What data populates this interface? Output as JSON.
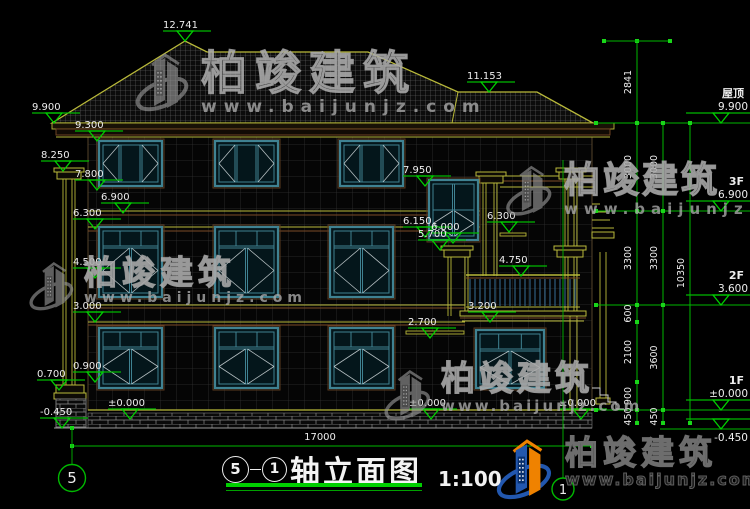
{
  "drawing": {
    "title": {
      "axis_left": "5",
      "axis_right": "1",
      "name": "轴立面图",
      "scale": "1:100"
    },
    "watermark": {
      "brand": "柏竣建筑",
      "url": "www.baijunjz.com"
    },
    "elevation_markers": [
      {
        "v": "12.741",
        "x": 185,
        "y": 41
      },
      {
        "v": "11.153",
        "x": 489,
        "y": 92
      },
      {
        "v": "9.900",
        "x": 54,
        "y": 123
      },
      {
        "v": "9.300",
        "x": 97,
        "y": 141
      },
      {
        "v": "8.250",
        "x": 63,
        "y": 171
      },
      {
        "v": "7.800",
        "x": 97,
        "y": 190
      },
      {
        "v": "6.900",
        "x": 123,
        "y": 213
      },
      {
        "v": "6.300",
        "x": 95,
        "y": 229
      },
      {
        "v": "4.500",
        "x": 95,
        "y": 278
      },
      {
        "v": "3.000",
        "x": 95,
        "y": 322
      },
      {
        "v": "0.900",
        "x": 95,
        "y": 382
      },
      {
        "v": "0.700",
        "x": 59,
        "y": 390
      },
      {
        "v": "-0.450",
        "x": 62,
        "y": 428
      },
      {
        "v": "±0.000",
        "x": 130,
        "y": 419
      },
      {
        "v": "7.950",
        "x": 425,
        "y": 186
      },
      {
        "v": "6.150",
        "x": 425,
        "y": 237
      },
      {
        "v": "6.000",
        "x": 453,
        "y": 243
      },
      {
        "v": "5.700",
        "x": 440,
        "y": 250
      },
      {
        "v": "6.300",
        "x": 509,
        "y": 232
      },
      {
        "v": "4.750",
        "x": 521,
        "y": 276
      },
      {
        "v": "3.200",
        "x": 490,
        "y": 322
      },
      {
        "v": "2.700",
        "x": 430,
        "y": 338
      },
      {
        "v": "±0.000",
        "x": 431,
        "y": 419
      },
      {
        "v": "±0.000",
        "x": 581,
        "y": 419
      }
    ],
    "floor_markers": [
      {
        "name": "屋顶",
        "v": "9.900",
        "y": 123
      },
      {
        "name": "3F",
        "v": "6.900",
        "y": 211
      },
      {
        "name": "2F",
        "v": "3.600",
        "y": 305
      },
      {
        "name": "1F",
        "v": "±0.000",
        "y": 410
      },
      {
        "name": "",
        "v": "-0.450",
        "y": 429,
        "below": true,
        "x1": 660
      }
    ],
    "vdims": [
      {
        "v": "2841",
        "x": 637,
        "y1": 41,
        "y2": 123
      },
      {
        "v": "3000",
        "x": 637,
        "y1": 123,
        "y2": 211
      },
      {
        "v": "3300",
        "x": 637,
        "y1": 211,
        "y2": 305
      },
      {
        "v": "600",
        "x": 637,
        "y1": 305,
        "y2": 322
      },
      {
        "v": "2100",
        "x": 637,
        "y1": 322,
        "y2": 382
      },
      {
        "v": "900",
        "x": 637,
        "y1": 382,
        "y2": 410
      },
      {
        "v": "450",
        "x": 637,
        "y1": 410,
        "y2": 423
      },
      {
        "v": "3000",
        "x": 663,
        "y1": 123,
        "y2": 211
      },
      {
        "v": "3300",
        "x": 663,
        "y1": 211,
        "y2": 305
      },
      {
        "v": "3600",
        "x": 663,
        "y1": 305,
        "y2": 410
      },
      {
        "v": "450",
        "x": 663,
        "y1": 410,
        "y2": 423
      },
      {
        "v": "10350",
        "x": 690,
        "y1": 123,
        "y2": 423
      }
    ],
    "hdim": {
      "v": "17000",
      "x1": 72,
      "x2": 592,
      "y": 446,
      "tx": 320,
      "ty": 440
    },
    "axis": {
      "left": {
        "label": "5",
        "x": 72,
        "cy": 478,
        "line_y1": 428,
        "line_y2": 464
      },
      "right": {
        "label": "1",
        "x": 563,
        "cy": 489,
        "line_y1": 160,
        "line_y2": 478
      }
    },
    "watermarks": [
      {
        "x": 133,
        "y": 50,
        "lw": 62,
        "lh": 64,
        "bs": 46,
        "us": 17,
        "lsb": 8,
        "lsu": 7,
        "dark": false
      },
      {
        "x": 28,
        "y": 256,
        "lw": 50,
        "lh": 60,
        "bs": 33,
        "us": 14,
        "lsb": 5,
        "lsu": 5,
        "dark": false
      },
      {
        "x": 503,
        "y": 163,
        "lw": 55,
        "lh": 55,
        "bs": 36,
        "us": 15,
        "lsb": 3,
        "lsu": 6,
        "dark": false
      },
      {
        "x": 383,
        "y": 362,
        "lw": 52,
        "lh": 66,
        "bs": 34,
        "us": 15,
        "lsb": 4,
        "lsu": 3,
        "dark": false
      },
      {
        "x": 493,
        "y": 436,
        "lw": 66,
        "lh": 66,
        "bs": 33,
        "us": 16,
        "lsb": 5,
        "lsu": 2,
        "dark": true
      }
    ]
  }
}
